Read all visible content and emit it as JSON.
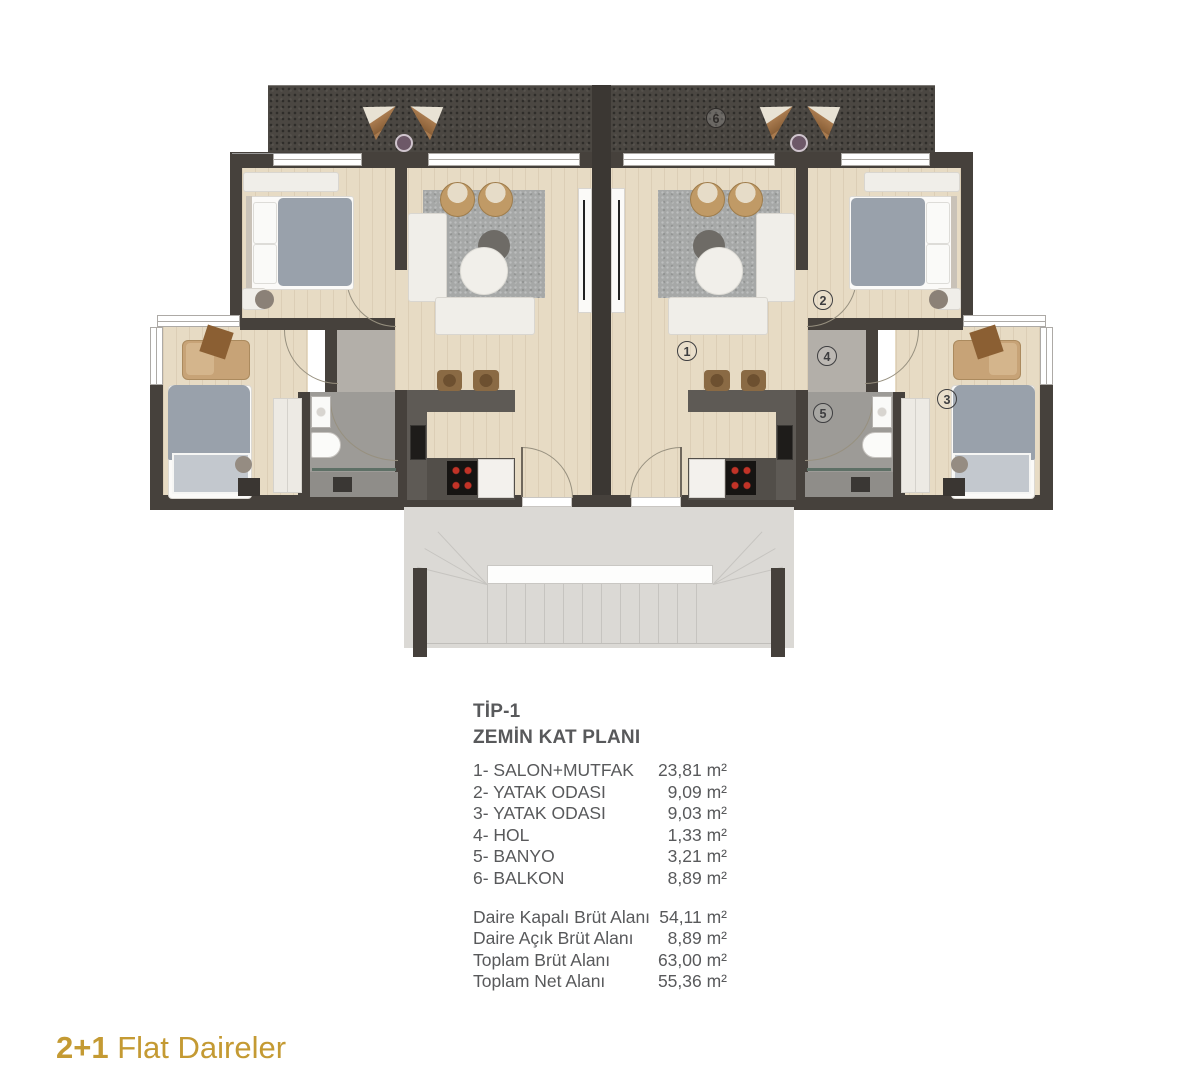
{
  "plan": {
    "labels": {
      "living": "1",
      "bedroom2": "2",
      "bedroom3": "3",
      "hall": "4",
      "bath": "5",
      "balcony": "6"
    }
  },
  "info": {
    "title": "TİP-1",
    "subtitle": "ZEMİN KAT PLANI",
    "rooms": [
      {
        "label": "1- SALON+MUTFAK",
        "area": "23,81 m²"
      },
      {
        "label": "2- YATAK ODASI",
        "area": "9,09 m²"
      },
      {
        "label": "3- YATAK ODASI",
        "area": "9,03 m²"
      },
      {
        "label": "4- HOL",
        "area": "1,33 m²"
      },
      {
        "label": "5- BANYO",
        "area": "3,21 m²"
      },
      {
        "label": "6- BALKON",
        "area": "8,89 m²"
      }
    ],
    "totals": [
      {
        "label": "Daire Kapalı Brüt Alanı",
        "area": "54,11 m²"
      },
      {
        "label": "Daire Açık Brüt Alanı",
        "area": "8,89 m²"
      },
      {
        "label": "Toplam Brüt Alanı",
        "area": "63,00 m²"
      },
      {
        "label": "Toplam Net Alanı",
        "area": "55,36 m²"
      }
    ]
  },
  "footer": {
    "highlight": "2+1",
    "text": "Flat Daireler"
  },
  "colors": {
    "text": "#58595B",
    "accent_gold": "#C49A33",
    "wall": "#46413C",
    "floor_wood": "#E7DBC4",
    "balcony": "#4B4742",
    "tile": "#9D9B97",
    "porch": "#DBD9D5"
  }
}
